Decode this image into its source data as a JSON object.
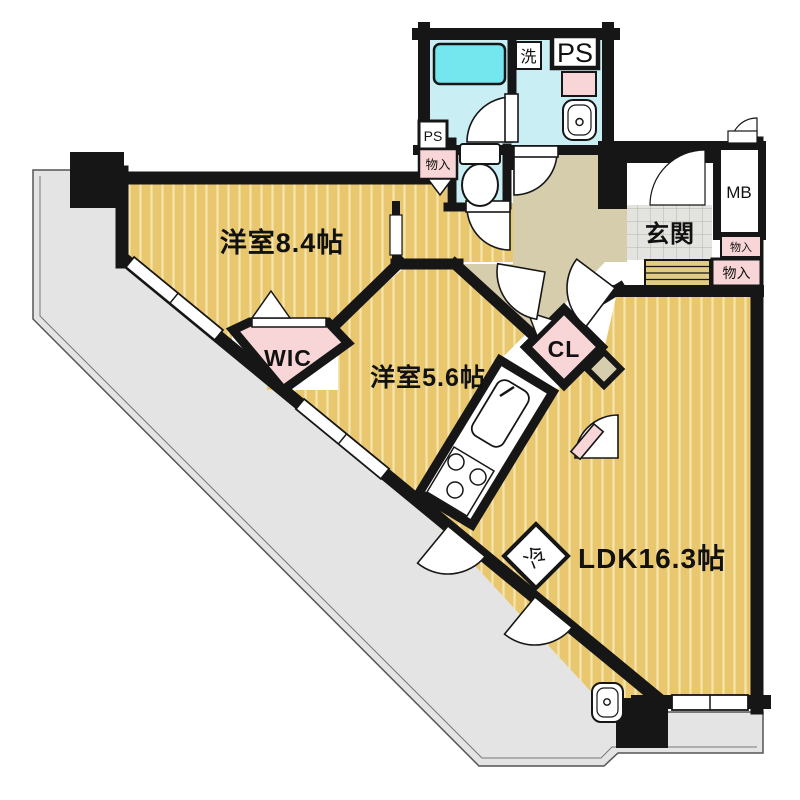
{
  "plan": {
    "type": "apartment-floor-plan",
    "rooms": {
      "bedroom1": "洋室8.4帖",
      "bedroom2": "洋室5.6帖",
      "ldk": "LDK16.3帖",
      "wic": "WIC",
      "closet": "CL",
      "entrance": "玄関"
    },
    "fixtures": {
      "washer": "洗",
      "ps_main": "PS",
      "ps_small": "PS",
      "meter_box": "MB",
      "storage_small": "物入",
      "storage_entry": "物入",
      "storage_hall": "物入",
      "refrigerator": "冷"
    },
    "colors": {
      "wall": "#161616",
      "room_floor": "#e9c76e",
      "room_stripe": "#f6e5ae",
      "hall_floor": "#d6cdac",
      "wet_area": "#c9eff5",
      "bathtub": "#74e6ee",
      "storage_pink": "#f8d5d6",
      "balcony": "#e4e4e4",
      "tile": "#e3e3df",
      "step": "#e2cb82"
    }
  }
}
